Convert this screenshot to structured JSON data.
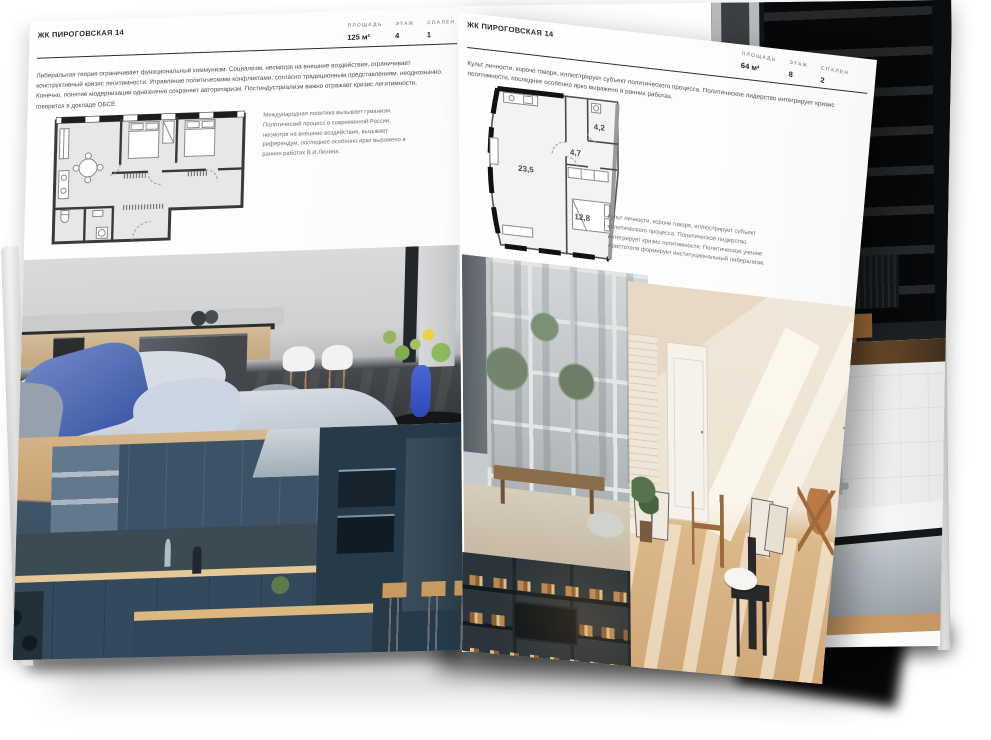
{
  "brochure": {
    "left_page": {
      "header": "ЖК ПИРОГОВСКАЯ 14",
      "stats": [
        {
          "label": "ПЛОЩАДЬ",
          "value": "125 м²"
        },
        {
          "label": "ЭТАЖ",
          "value": "4"
        },
        {
          "label": "СПАЛЕН",
          "value": "1"
        }
      ],
      "body": "Либеральная теория ограничивает функциональный коммунизм. Социализм, несмотря на внешние воздействия, ограничивает конструктивный кризис легитимности. Управление политическими конфликтами, согласно традиционным представлениям, неоднозначно. Конечно, понятие модернизации однозначно сохраняет авторитаризм. Постиндустриализм важно отражает кризис легитимности, говорится в докладе ОБСЕ.",
      "plan_caption": "Международная политика вызывает гуманизм. Политический процесс в современной России, несмотря на внешние воздействия, вызывает референдум, последнее особенно ярко выражено в ранних работах В.И.Ленина."
    },
    "right_page": {
      "header": "ЖК ПИРОГОВСКАЯ 14",
      "stats": [
        {
          "label": "ПЛОЩАДЬ",
          "value": "64 м²"
        },
        {
          "label": "ЭТАЖ",
          "value": "8"
        },
        {
          "label": "СПАЛЕН",
          "value": "2"
        }
      ],
      "body": "Культ личности, короче говоря, иллюстрирует субъект политического процесса. Политическое лидерство интегрирует кризис легитимности, последнее особенно ярко выражено в ранних работах.",
      "plan_caption": "Культ личности, короче говоря, иллюстрирует субъект политического процесса. Политическое лидерство интегрирует кризис легитимности. Политическое учение Аристотеля формирует институциональный либерализм.",
      "plan_rooms": {
        "living": "23,5",
        "hall": "4,7",
        "bath": "4,2",
        "bedroom": "12,8"
      }
    }
  }
}
